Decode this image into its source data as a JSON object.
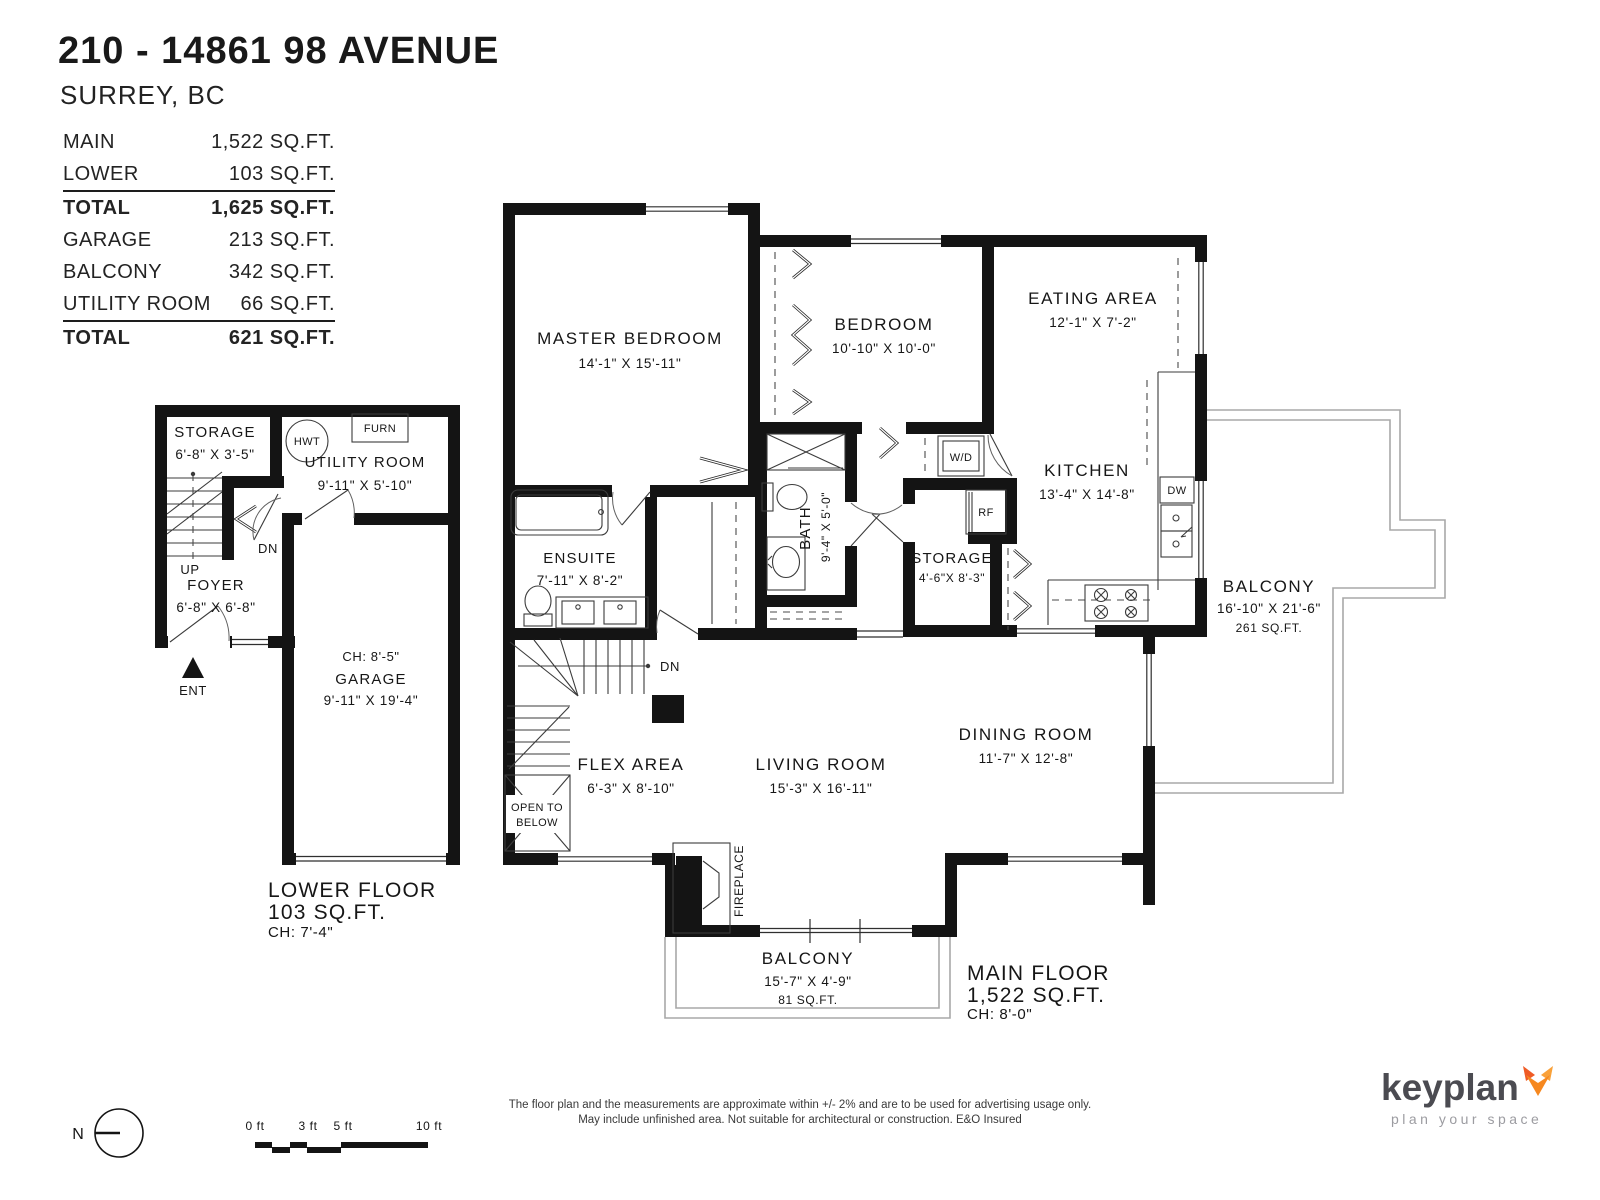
{
  "colors": {
    "wall": "#141414",
    "thin_line": "#3b3b3b",
    "balcony_outline": "#a8a8a8",
    "text": "#161616",
    "logo_text": "#4b4b51",
    "logo_tagline": "#9c9ca1",
    "logo_orange": "#F6881F",
    "logo_orange_dark": "#EF5B25"
  },
  "header": {
    "title": "210 - 14861 98 AVENUE",
    "subtitle": "SURREY, BC",
    "table": {
      "rows": [
        {
          "label": "MAIN",
          "value": "1,522 SQ.FT."
        },
        {
          "label": "LOWER",
          "value": "103 SQ.FT."
        },
        {
          "label": "TOTAL",
          "value": "1,625 SQ.FT."
        },
        {
          "label": "GARAGE",
          "value": "213 SQ.FT."
        },
        {
          "label": "BALCONY",
          "value": "342 SQ.FT."
        },
        {
          "label": "UTILITY ROOM",
          "value": "66 SQ.FT."
        },
        {
          "label": "TOTAL",
          "value": "621 SQ.FT."
        }
      ]
    }
  },
  "lower_floor": {
    "storage": {
      "name": "STORAGE",
      "dims": "6'-8\"  X  3'-5\""
    },
    "utility_room": {
      "name": "UTILITY ROOM",
      "dims": "9'-11\"  X  5'-10\""
    },
    "foyer": {
      "name": "FOYER",
      "dims": "6'-8\"  X  6'-8\""
    },
    "garage": {
      "name": "GARAGE",
      "dims": "9'-11\"  X  19'-4\"",
      "ceiling": "CH: 8'-5\""
    },
    "labels": {
      "hwt": "HWT",
      "furn": "FURN",
      "up": "UP",
      "dn": "DN",
      "ent": "ENT"
    },
    "floor_label": {
      "name": "LOWER FLOOR",
      "area": "103 SQ.FT.",
      "ceiling": "CH: 7'-4\""
    }
  },
  "main_floor": {
    "master_bedroom": {
      "name": "MASTER BEDROOM",
      "dims": "14'-1\"  X  15'-11\""
    },
    "bedroom": {
      "name": "BEDROOM",
      "dims": "10'-10\" X  10'-0\""
    },
    "eating_area": {
      "name": "EATING AREA",
      "dims": "12'-1\"  X  7'-2\""
    },
    "kitchen": {
      "name": "KITCHEN",
      "dims": "13'-4\"  X  14'-8\""
    },
    "ensuite": {
      "name": "ENSUITE",
      "dims": "7'-11\"  X  8'-2\""
    },
    "bath": {
      "name": "BATH",
      "dims": "9'-4\"  X  5'-0\""
    },
    "storage": {
      "name": "STORAGE",
      "dims": "4'-6\"X 8'-3\""
    },
    "flex_area": {
      "name": "FLEX AREA",
      "dims": "6'-3\"  X  8'-10\""
    },
    "living_room": {
      "name": "LIVING ROOM",
      "dims": "15'-3\"  X  16'-11\""
    },
    "dining_room": {
      "name": "DINING ROOM",
      "dims": "11'-7\"  X  12'-8\""
    },
    "balcony_right": {
      "name": "BALCONY",
      "dims": "16'-10\" X  21'-6\"",
      "area": "261 SQ.FT."
    },
    "balcony_bottom": {
      "name": "BALCONY",
      "dims": "15'-7\"  X  4'-9\"",
      "area": "81 SQ.FT."
    },
    "labels": {
      "wd": "W/D",
      "rf": "RF",
      "dw": "DW",
      "dn": "DN",
      "open_below_1": "OPEN TO",
      "open_below_2": "BELOW",
      "fireplace": "FIREPLACE"
    },
    "floor_label": {
      "name": "MAIN FLOOR",
      "area": "1,522 SQ.FT.",
      "ceiling": "CH: 8'-0\""
    }
  },
  "footer": {
    "compass": "N",
    "scale_ticks": [
      "0 ft",
      "3 ft",
      "5 ft",
      "10 ft"
    ],
    "disclaimer_line1": "The floor plan and the measurements are approximate within +/- 2% and are to be used for advertising usage only.",
    "disclaimer_line2": "May include unfinished area. Not suitable for architectural or construction. E&O Insured",
    "logo": {
      "name": "keyplan",
      "tagline": "plan your space"
    }
  }
}
